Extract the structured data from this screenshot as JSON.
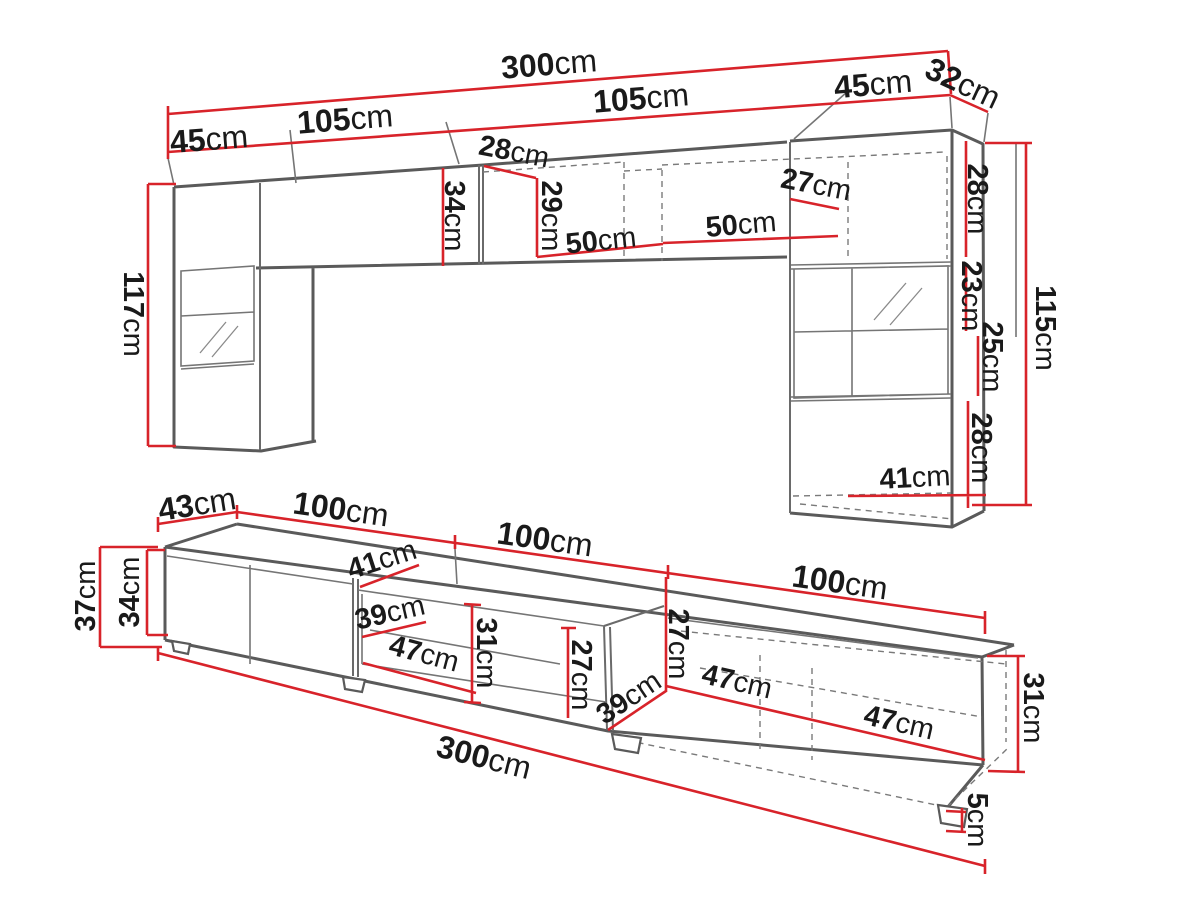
{
  "colors": {
    "dimension_red": "#d8232a",
    "outline_gray": "#5a5a5a",
    "label_black": "#1a1a1a",
    "background": "#ffffff"
  },
  "top_view": {
    "name": "wall-unit-upper-section",
    "labels": [
      {
        "id": "overall-width",
        "num": "300",
        "unit": "cm"
      },
      {
        "id": "left-cabinet-width",
        "num": "45",
        "unit": "cm"
      },
      {
        "id": "left-shelf-width",
        "num": "105",
        "unit": "cm"
      },
      {
        "id": "right-shelf-width",
        "num": "105",
        "unit": "cm"
      },
      {
        "id": "right-cabinet-width",
        "num": "45",
        "unit": "cm"
      },
      {
        "id": "right-cabinet-depth",
        "num": "32",
        "unit": "cm"
      },
      {
        "id": "left-shelf-depth",
        "num": "28",
        "unit": "cm"
      },
      {
        "id": "left-shelf-height",
        "num": "34",
        "unit": "cm"
      },
      {
        "id": "right-shelf-height",
        "num": "29",
        "unit": "cm"
      },
      {
        "id": "shelf-span-left",
        "num": "50",
        "unit": "cm"
      },
      {
        "id": "shelf-span-right",
        "num": "50",
        "unit": "cm"
      },
      {
        "id": "right-cabinet-top-depth",
        "num": "27",
        "unit": "cm"
      },
      {
        "id": "right-upper-section-height",
        "num": "28",
        "unit": "cm"
      },
      {
        "id": "right-glass-section-height",
        "num": "23",
        "unit": "cm"
      },
      {
        "id": "right-mid-section-height",
        "num": "25",
        "unit": "cm"
      },
      {
        "id": "right-lower-section-height",
        "num": "28",
        "unit": "cm"
      },
      {
        "id": "right-bottom-width",
        "num": "41",
        "unit": "cm"
      },
      {
        "id": "left-cabinet-height",
        "num": "117",
        "unit": "cm"
      },
      {
        "id": "right-cabinet-height",
        "num": "115",
        "unit": "cm"
      }
    ]
  },
  "bottom_view": {
    "name": "tv-stand-lower-section",
    "labels": [
      {
        "id": "stand-depth",
        "num": "43",
        "unit": "cm"
      },
      {
        "id": "section-width-1",
        "num": "100",
        "unit": "cm"
      },
      {
        "id": "section-width-2",
        "num": "100",
        "unit": "cm"
      },
      {
        "id": "section-width-3",
        "num": "100",
        "unit": "cm"
      },
      {
        "id": "stand-total-height",
        "num": "37",
        "unit": "cm"
      },
      {
        "id": "stand-body-height",
        "num": "34",
        "unit": "cm"
      },
      {
        "id": "interior-depth-top",
        "num": "41",
        "unit": "cm"
      },
      {
        "id": "interior-depth-left",
        "num": "39",
        "unit": "cm"
      },
      {
        "id": "interior-width-left",
        "num": "47",
        "unit": "cm"
      },
      {
        "id": "interior-height-left",
        "num": "31",
        "unit": "cm"
      },
      {
        "id": "interior-height-middle",
        "num": "27",
        "unit": "cm"
      },
      {
        "id": "interior-height-right",
        "num": "27",
        "unit": "cm"
      },
      {
        "id": "interior-depth-right",
        "num": "39",
        "unit": "cm"
      },
      {
        "id": "interior-width-middle",
        "num": "47",
        "unit": "cm"
      },
      {
        "id": "interior-width-right",
        "num": "47",
        "unit": "cm"
      },
      {
        "id": "right-section-height",
        "num": "31",
        "unit": "cm"
      },
      {
        "id": "overall-width",
        "num": "300",
        "unit": "cm"
      },
      {
        "id": "foot-height",
        "num": "5",
        "unit": "cm"
      }
    ]
  }
}
